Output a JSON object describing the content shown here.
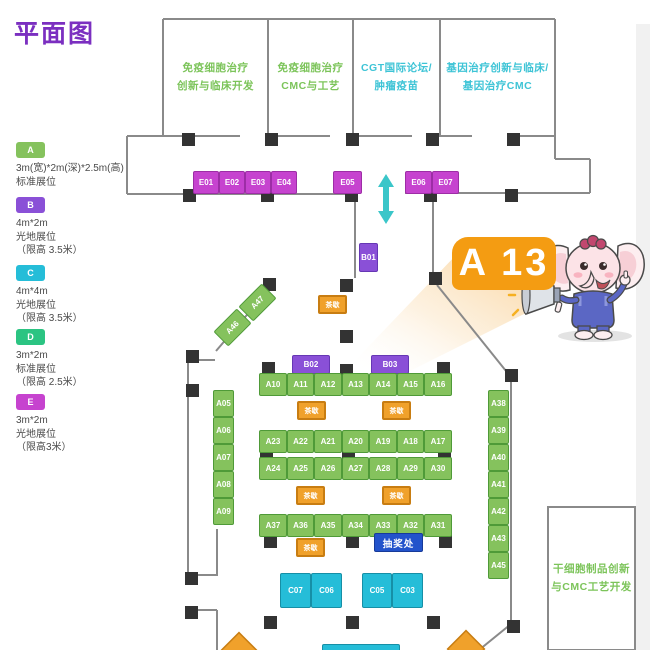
{
  "title": "平面图",
  "palette": {
    "title_color": "#7b2fc0",
    "wall": "#8a8a8a",
    "pillar": "#333333",
    "booth_A": "#85c25d",
    "booth_B": "#8a50d7",
    "booth_C": "#25bdd8",
    "booth_D": "#2bc482",
    "booth_E": "#c643cf",
    "tea_orange": "#f0a12b",
    "raffle_blue": "#2353cb",
    "callout_orange": "#f49c12",
    "room_text_green": "#7cc45a",
    "room_text_cyan": "#3ec4d6",
    "arrow_cyan": "#3bc6c9"
  },
  "legend": [
    {
      "key": "A",
      "color": "#85c25d",
      "y": 142,
      "lines": [
        "3m(宽)*2m(深)*2.5m(高)",
        "标准展位"
      ]
    },
    {
      "key": "B",
      "color": "#8a50d7",
      "y": 197,
      "lines": [
        "4m*2m",
        "光地展位",
        "（限高 3.5米）"
      ]
    },
    {
      "key": "C",
      "color": "#25bdd8",
      "y": 265,
      "lines": [
        "4m*4m",
        "光地展位",
        "（限高 3.5米）"
      ]
    },
    {
      "key": "D",
      "color": "#2bc482",
      "y": 329,
      "lines": [
        "3m*2m",
        "标准展位",
        "（限高 2.5米）"
      ]
    },
    {
      "key": "E",
      "color": "#c643cf",
      "y": 394,
      "lines": [
        "3m*2m",
        "光地展位",
        "（限高3米）"
      ]
    }
  ],
  "rooms": [
    {
      "id": "room-immune-clinical",
      "color": "green",
      "x": 163,
      "y": 19,
      "w": 105,
      "h": 117,
      "lines": [
        "免疫细胞治疗",
        "创新与临床开发"
      ]
    },
    {
      "id": "room-immune-cmc",
      "color": "green",
      "x": 268,
      "y": 19,
      "w": 85,
      "h": 117,
      "lines": [
        "免疫细胞治疗",
        "CMC与工艺"
      ]
    },
    {
      "id": "room-cgt-forum",
      "color": "cyan",
      "x": 353,
      "y": 19,
      "w": 87,
      "h": 117,
      "lines": [
        "CGT国际论坛/",
        "肿瘤疫苗"
      ]
    },
    {
      "id": "room-gene-therapy",
      "color": "cyan",
      "x": 440,
      "y": 19,
      "w": 115,
      "h": 117,
      "lines": [
        "基因治疗创新与临床/",
        "基因治疗CMC"
      ]
    },
    {
      "id": "room-stemcell-cmc",
      "color": "green",
      "x": 548,
      "y": 507,
      "w": 87,
      "h": 143,
      "lines": [
        "干细胞制品创新",
        "与CMC工艺开发"
      ]
    }
  ],
  "callout": {
    "label": "A 13"
  },
  "booths": [
    {
      "id": "E01",
      "type": "E",
      "x": 193,
      "y": 171,
      "w": 26,
      "h": 23
    },
    {
      "id": "E02",
      "type": "E",
      "x": 219,
      "y": 171,
      "w": 26,
      "h": 23
    },
    {
      "id": "E03",
      "type": "E",
      "x": 245,
      "y": 171,
      "w": 26,
      "h": 23
    },
    {
      "id": "E04",
      "type": "E",
      "x": 271,
      "y": 171,
      "w": 26,
      "h": 23
    },
    {
      "id": "E05",
      "type": "E",
      "x": 333,
      "y": 171,
      "w": 29,
      "h": 23
    },
    {
      "id": "E06",
      "type": "E",
      "x": 405,
      "y": 171,
      "w": 27,
      "h": 23
    },
    {
      "id": "E07",
      "type": "E",
      "x": 432,
      "y": 171,
      "w": 27,
      "h": 23
    },
    {
      "id": "B01",
      "type": "B",
      "x": 359,
      "y": 243,
      "w": 19,
      "h": 29
    },
    {
      "id": "B02",
      "type": "B",
      "x": 292,
      "y": 355,
      "w": 38,
      "h": 19
    },
    {
      "id": "B03",
      "type": "B",
      "x": 371,
      "y": 355,
      "w": 38,
      "h": 19
    },
    {
      "id": "A10",
      "type": "A",
      "x": 259,
      "y": 373,
      "w": 28,
      "h": 23
    },
    {
      "id": "A11",
      "type": "A",
      "x": 287,
      "y": 373,
      "w": 27,
      "h": 23
    },
    {
      "id": "A12",
      "type": "A",
      "x": 314,
      "y": 373,
      "w": 28,
      "h": 23
    },
    {
      "id": "A13",
      "type": "A",
      "x": 342,
      "y": 373,
      "w": 27,
      "h": 23
    },
    {
      "id": "A14",
      "type": "A",
      "x": 369,
      "y": 373,
      "w": 28,
      "h": 23
    },
    {
      "id": "A15",
      "type": "A",
      "x": 397,
      "y": 373,
      "w": 27,
      "h": 23
    },
    {
      "id": "A16",
      "type": "A",
      "x": 424,
      "y": 373,
      "w": 28,
      "h": 23
    },
    {
      "id": "A23",
      "type": "A",
      "x": 259,
      "y": 430,
      "w": 28,
      "h": 23
    },
    {
      "id": "A22",
      "type": "A",
      "x": 287,
      "y": 430,
      "w": 27,
      "h": 23
    },
    {
      "id": "A21",
      "type": "A",
      "x": 314,
      "y": 430,
      "w": 28,
      "h": 23
    },
    {
      "id": "A20",
      "type": "A",
      "x": 342,
      "y": 430,
      "w": 27,
      "h": 23
    },
    {
      "id": "A19",
      "type": "A",
      "x": 369,
      "y": 430,
      "w": 28,
      "h": 23
    },
    {
      "id": "A18",
      "type": "A",
      "x": 397,
      "y": 430,
      "w": 27,
      "h": 23
    },
    {
      "id": "A17",
      "type": "A",
      "x": 424,
      "y": 430,
      "w": 28,
      "h": 23
    },
    {
      "id": "A24",
      "type": "A",
      "x": 259,
      "y": 457,
      "w": 28,
      "h": 23
    },
    {
      "id": "A25",
      "type": "A",
      "x": 287,
      "y": 457,
      "w": 27,
      "h": 23
    },
    {
      "id": "A26",
      "type": "A",
      "x": 314,
      "y": 457,
      "w": 28,
      "h": 23
    },
    {
      "id": "A27",
      "type": "A",
      "x": 342,
      "y": 457,
      "w": 27,
      "h": 23
    },
    {
      "id": "A28",
      "type": "A",
      "x": 369,
      "y": 457,
      "w": 28,
      "h": 23
    },
    {
      "id": "A29",
      "type": "A",
      "x": 397,
      "y": 457,
      "w": 27,
      "h": 23
    },
    {
      "id": "A30",
      "type": "A",
      "x": 424,
      "y": 457,
      "w": 28,
      "h": 23
    },
    {
      "id": "A37",
      "type": "A",
      "x": 259,
      "y": 514,
      "w": 28,
      "h": 23
    },
    {
      "id": "A36",
      "type": "A",
      "x": 287,
      "y": 514,
      "w": 27,
      "h": 23
    },
    {
      "id": "A35",
      "type": "A",
      "x": 314,
      "y": 514,
      "w": 28,
      "h": 23
    },
    {
      "id": "A34",
      "type": "A",
      "x": 342,
      "y": 514,
      "w": 27,
      "h": 23
    },
    {
      "id": "A33",
      "type": "A",
      "x": 369,
      "y": 514,
      "w": 28,
      "h": 23
    },
    {
      "id": "A32",
      "type": "A",
      "x": 397,
      "y": 514,
      "w": 27,
      "h": 23
    },
    {
      "id": "A31",
      "type": "A",
      "x": 424,
      "y": 514,
      "w": 28,
      "h": 23
    },
    {
      "id": "A05",
      "type": "A",
      "x": 213,
      "y": 390,
      "w": 21,
      "h": 27
    },
    {
      "id": "A06",
      "type": "A",
      "x": 213,
      "y": 417,
      "w": 21,
      "h": 27
    },
    {
      "id": "A07",
      "type": "A",
      "x": 213,
      "y": 444,
      "w": 21,
      "h": 27
    },
    {
      "id": "A08",
      "type": "A",
      "x": 213,
      "y": 471,
      "w": 21,
      "h": 27
    },
    {
      "id": "A09",
      "type": "A",
      "x": 213,
      "y": 498,
      "w": 21,
      "h": 27
    },
    {
      "id": "A38",
      "type": "A",
      "x": 488,
      "y": 390,
      "w": 21,
      "h": 27
    },
    {
      "id": "A39",
      "type": "A",
      "x": 488,
      "y": 417,
      "w": 21,
      "h": 27
    },
    {
      "id": "A40",
      "type": "A",
      "x": 488,
      "y": 444,
      "w": 21,
      "h": 27
    },
    {
      "id": "A41",
      "type": "A",
      "x": 488,
      "y": 471,
      "w": 21,
      "h": 27
    },
    {
      "id": "A42",
      "type": "A",
      "x": 488,
      "y": 498,
      "w": 21,
      "h": 27
    },
    {
      "id": "A43",
      "type": "A",
      "x": 488,
      "y": 525,
      "w": 21,
      "h": 27
    },
    {
      "id": "A45",
      "type": "A",
      "x": 488,
      "y": 552,
      "w": 21,
      "h": 27
    },
    {
      "id": "A46",
      "type": "A",
      "x": 216,
      "y": 317,
      "w": 33,
      "h": 21,
      "rot": -45
    },
    {
      "id": "A47",
      "type": "A",
      "x": 241,
      "y": 292,
      "w": 33,
      "h": 21,
      "rot": -45
    },
    {
      "id": "C07",
      "type": "C",
      "x": 280,
      "y": 573,
      "w": 31,
      "h": 35
    },
    {
      "id": "C06",
      "type": "C",
      "x": 311,
      "y": 573,
      "w": 31,
      "h": 35
    },
    {
      "id": "C05",
      "type": "C",
      "x": 362,
      "y": 573,
      "w": 30,
      "h": 35
    },
    {
      "id": "C03",
      "type": "C",
      "x": 392,
      "y": 573,
      "w": 31,
      "h": 35
    },
    {
      "id": "",
      "type": "C",
      "x": 322,
      "y": 644,
      "w": 78,
      "h": 12
    }
  ],
  "markers": [
    {
      "type": "tea",
      "label": "茶歇",
      "x": 318,
      "y": 295,
      "w": 29,
      "h": 19
    },
    {
      "type": "tea",
      "label": "茶歇",
      "x": 297,
      "y": 401,
      "w": 29,
      "h": 19
    },
    {
      "type": "tea",
      "label": "茶歇",
      "x": 382,
      "y": 401,
      "w": 29,
      "h": 19
    },
    {
      "type": "tea",
      "label": "茶歇",
      "x": 296,
      "y": 486,
      "w": 29,
      "h": 19
    },
    {
      "type": "tea",
      "label": "茶歇",
      "x": 382,
      "y": 486,
      "w": 29,
      "h": 19
    },
    {
      "type": "tea",
      "label": "茶歇",
      "x": 296,
      "y": 538,
      "w": 29,
      "h": 19
    },
    {
      "type": "raffle",
      "label": "抽奖处",
      "x": 374,
      "y": 533,
      "w": 49,
      "h": 19
    }
  ]
}
